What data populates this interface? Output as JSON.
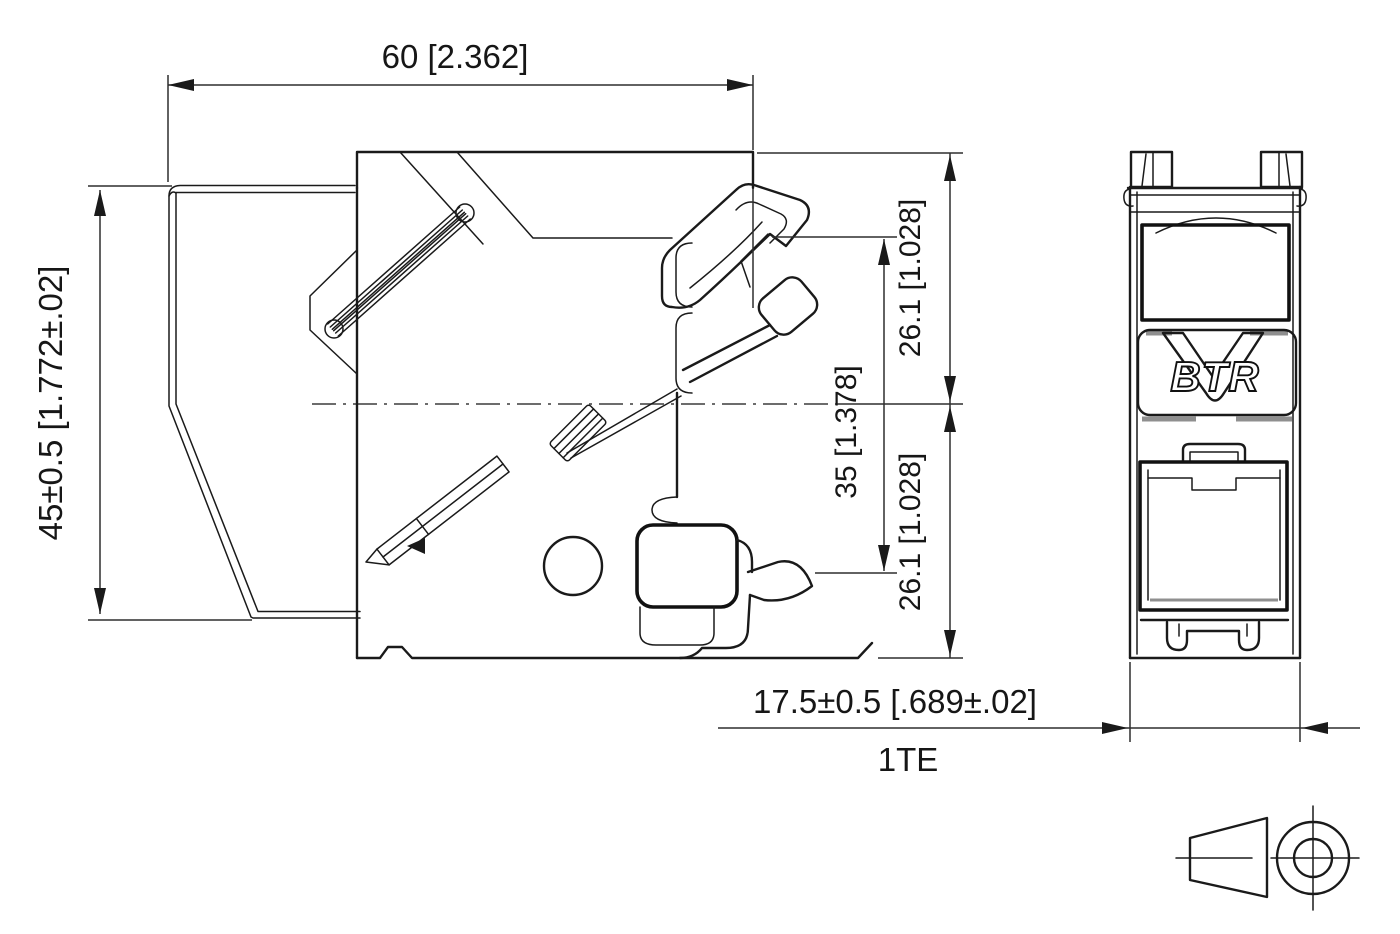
{
  "drawing": {
    "background_color": "#ffffff",
    "line_color": "#1a1a1a",
    "shadow_color": "#8f8f8f",
    "dimensions": {
      "width_top": "60 [2.362]",
      "height_left": "45±0.5 [1.772±.02]",
      "upper_right": "26.1 [1.028]",
      "middle_right": "35 [1.378]",
      "lower_right": "26.1 [1.028]",
      "module_width": "17.5±0.5 [.689±.02]",
      "module_unit": "1TE"
    },
    "front_view": {
      "logo_text": "BTR"
    },
    "symbols": {
      "projection": "first-angle-projection-symbol"
    }
  }
}
